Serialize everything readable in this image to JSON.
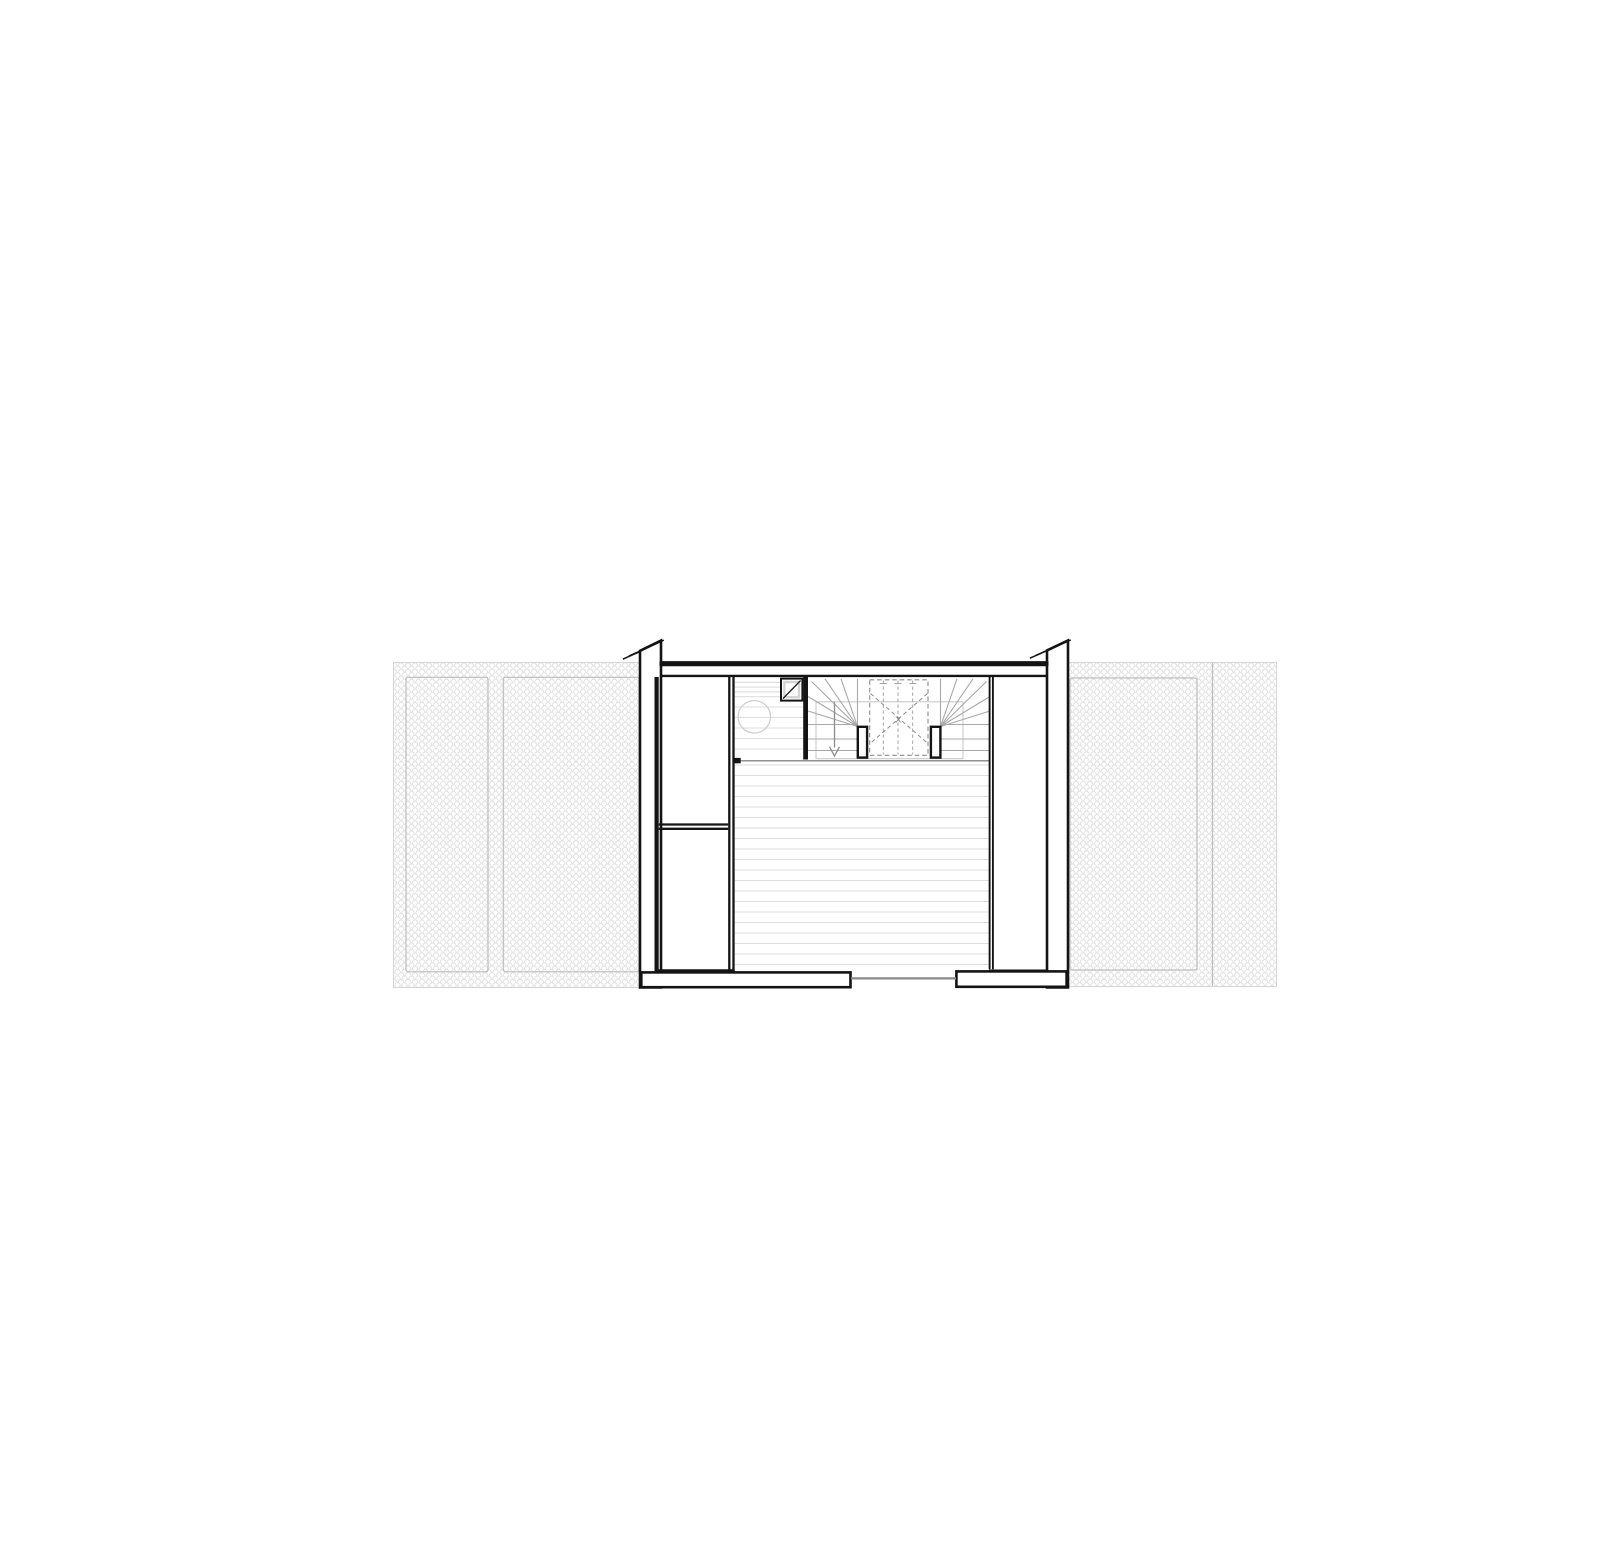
{
  "document": {
    "type": "architectural floor plan",
    "view": "top-down plan, upper level with stairwell",
    "sheet_background": "#ffffff"
  },
  "plan": {
    "building": {
      "left_party_wall": "cut wall with break slashes at top",
      "right_party_wall": "cut wall with break slashes at top",
      "top_facade_wall": "solid",
      "bottom_facade_wall": "two wall piers with central opening",
      "door_opening": {
        "position": "bottom center",
        "threshold_color": "#8a8a8a"
      }
    },
    "stair": {
      "void_mark": "x",
      "direction_arrow": "down",
      "type": "U-shaped winder stair with two newel posts",
      "newel_posts": 2,
      "upper_flight": "dashed (above cut plane)"
    },
    "closet": {
      "location": "left side",
      "compartments": 2,
      "shelf_lines": 2
    },
    "fixtures": {
      "skylight_square": 1,
      "round_fixture": 1
    },
    "roofs": {
      "left_panels": 2,
      "right_panels": 2,
      "hatch_style": "fish-scale roof tiles"
    }
  },
  "colors": {
    "wall": "#141414",
    "floor_board_line": "#dedede",
    "stair_line": "#a8a8a8",
    "dashed_line": "#8c8c8c",
    "hatch_line": "#e2e2e2",
    "panel_outline": "#bdbdbd",
    "opening_line": "#8a8a8a",
    "fixture_outline": "#cfcfcf"
  }
}
